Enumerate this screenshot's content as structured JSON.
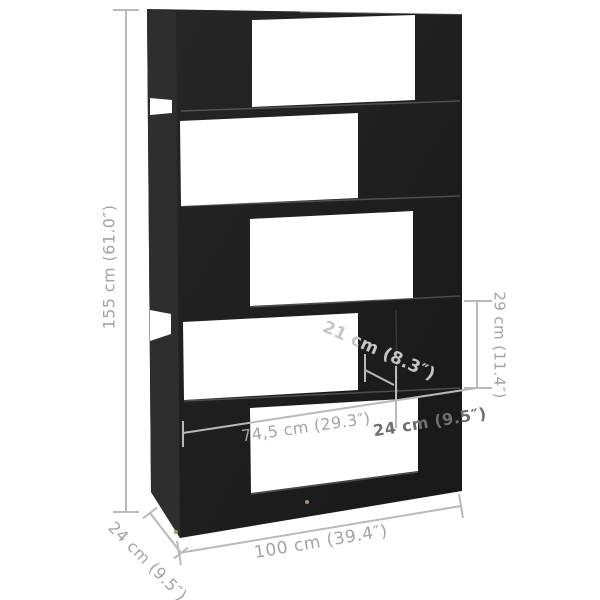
{
  "diagram": {
    "type": "furniture-dimension-diagram",
    "subject": "zigzag-room-divider-bookshelf-5-tiers",
    "dimension_labels": {
      "height": "155 cm (61.0″)",
      "opening_height": "29 cm (11.4″)",
      "divider_width": "21 cm (8.3″)",
      "inner_width": "74,5 cm (29.3″)",
      "side_width": "24 cm (9.5″)",
      "total_width": "100 cm (39.4″)",
      "depth": "24 cm (9.5″)"
    },
    "colors": {
      "background": "#ffffff",
      "furniture_front": "#1f1f1f",
      "furniture_side": "#2e2e2e",
      "dimension_line": "#b9b9b9",
      "label_text": "#a3a3a3",
      "label_text_dark": "#6f6f6f",
      "label_text_light": "#c6c6c6",
      "feet_dot": "#a8916a"
    }
  }
}
